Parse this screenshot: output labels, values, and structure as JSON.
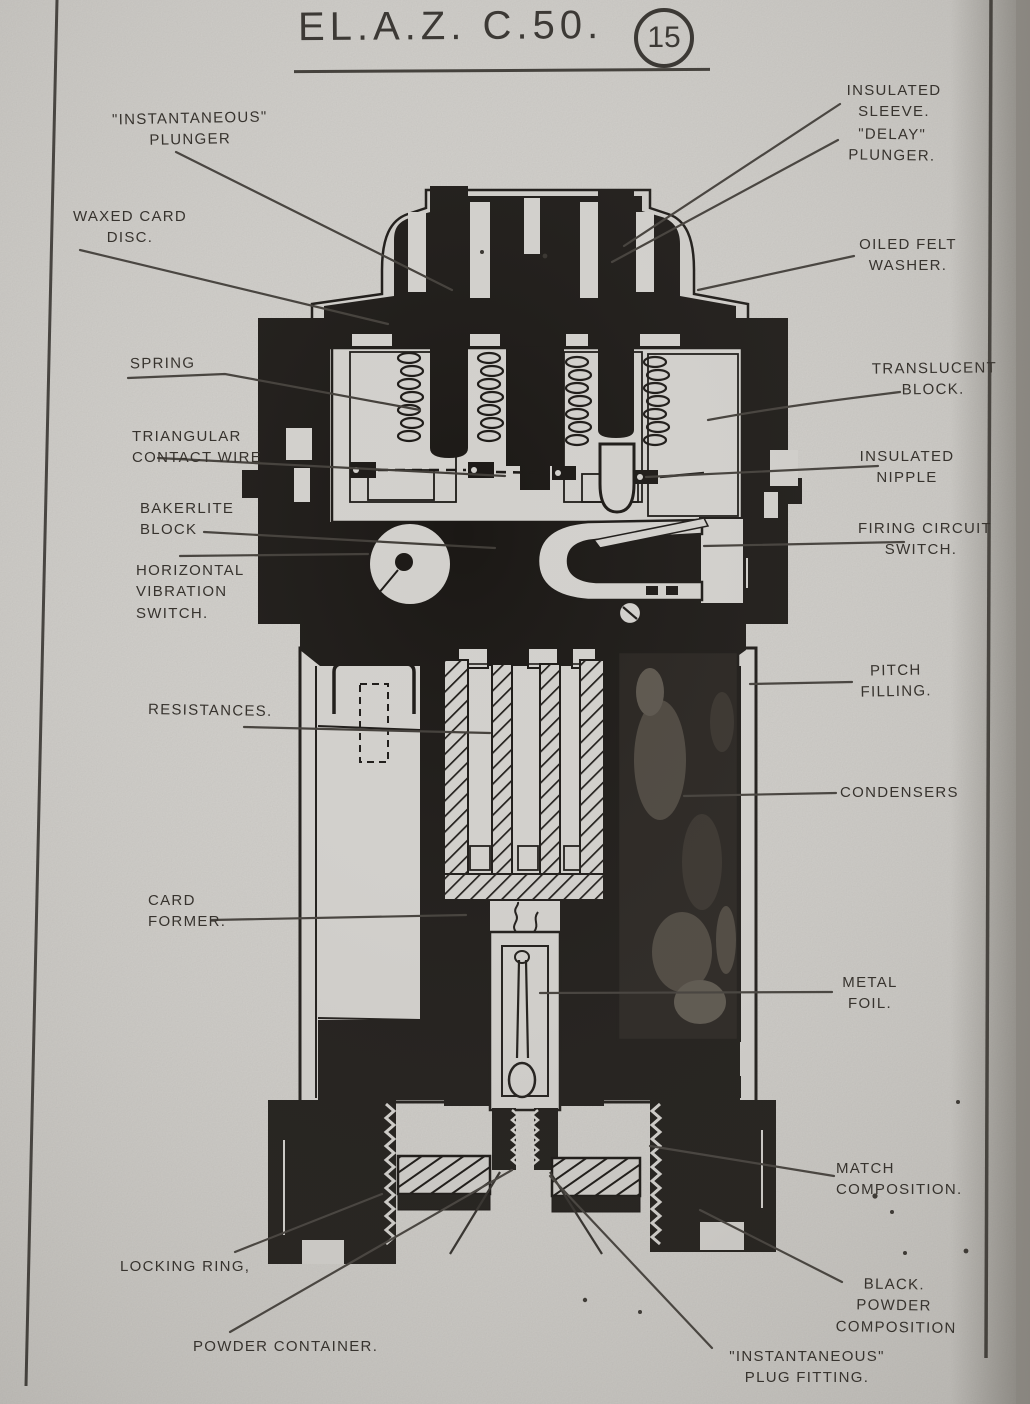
{
  "title": {
    "text": "EL.A.Z. C.50.",
    "figure_number": "15"
  },
  "colors": {
    "paper": "#d6d4d0",
    "ink": "#1b1815",
    "pencil": "#413d38"
  },
  "labels": {
    "instantaneous_plunger": {
      "lines": [
        "\"INSTANTANEOUS\"",
        "PLUNGER"
      ]
    },
    "waxed_card_disc": {
      "lines": [
        "WAXED CARD",
        "DISC."
      ]
    },
    "spring": {
      "lines": [
        "SPRING"
      ]
    },
    "triangular_contact_wire": {
      "lines": [
        "TRIANGULAR",
        "CONTACT WIRE"
      ]
    },
    "bakerlite_block": {
      "lines": [
        "BAKERLITE",
        "BLOCK"
      ]
    },
    "horizontal_vibration_switch": {
      "lines": [
        "HORIZONTAL",
        "VIBRATION",
        "SWITCH."
      ]
    },
    "resistances": {
      "lines": [
        "RESISTANCES."
      ]
    },
    "card_former": {
      "lines": [
        "CARD",
        "FORMER."
      ]
    },
    "locking_ring": {
      "lines": [
        "LOCKING RING,"
      ]
    },
    "powder_container": {
      "lines": [
        "POWDER CONTAINER."
      ]
    },
    "insulated_sleeve": {
      "lines": [
        "INSULATED",
        "SLEEVE."
      ]
    },
    "delay_plunger": {
      "lines": [
        "\"DELAY\"",
        "PLUNGER."
      ]
    },
    "oiled_felt_washer": {
      "lines": [
        "OILED FELT",
        "WASHER."
      ]
    },
    "translucent_block": {
      "lines": [
        "TRANSLUCENT",
        "BLOCK."
      ]
    },
    "insulated_nipple": {
      "lines": [
        "INSULATED",
        "NIPPLE"
      ]
    },
    "firing_circuit_switch": {
      "lines": [
        "FIRING CIRCUIT",
        "SWITCH."
      ]
    },
    "pitch_filling": {
      "lines": [
        "PITCH",
        "FILLING."
      ]
    },
    "condensers": {
      "lines": [
        "CONDENSERS"
      ]
    },
    "metal_foil": {
      "lines": [
        "METAL",
        "FOIL."
      ]
    },
    "match_composition": {
      "lines": [
        "MATCH",
        "COMPOSITION."
      ]
    },
    "black_powder_composition": {
      "lines": [
        "BLACK.",
        "POWDER",
        "COMPOSITION"
      ]
    },
    "instantaneous_plug_fitting": {
      "lines": [
        "\"INSTANTANEOUS\"",
        "PLUG FITTING."
      ]
    }
  }
}
